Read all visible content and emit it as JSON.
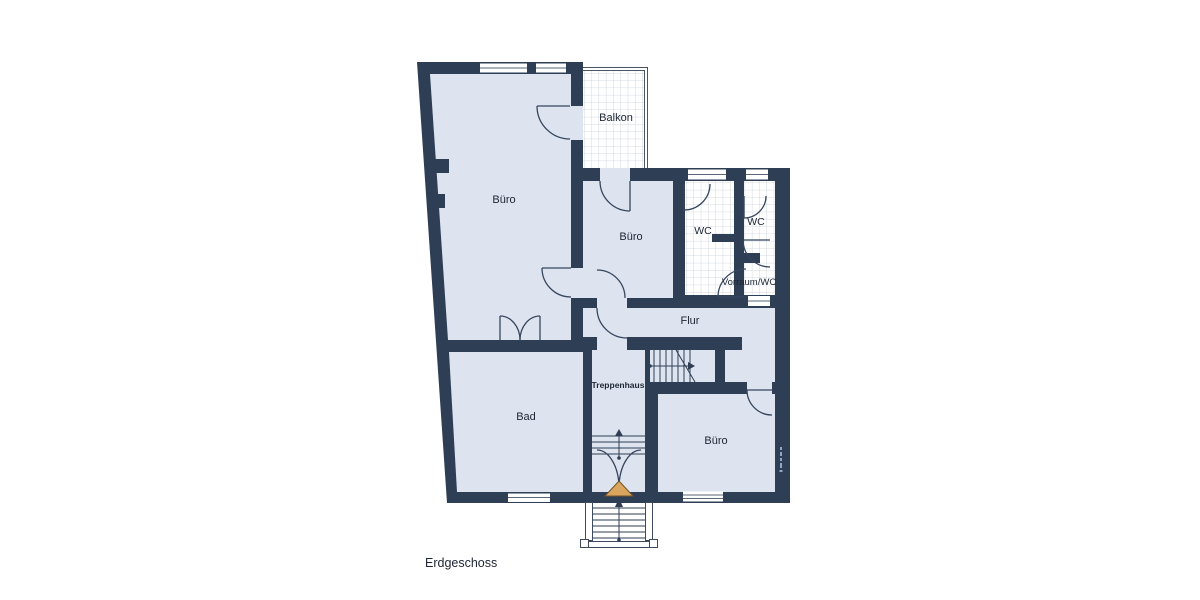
{
  "title": {
    "floor_label": "Erdgeschoss"
  },
  "rooms": {
    "buero_top_left": {
      "label": "Büro"
    },
    "balkon": {
      "label": "Balkon"
    },
    "buero_middle": {
      "label": "Büro"
    },
    "wc_main": {
      "label": "WC"
    },
    "wc_small": {
      "label": "WC"
    },
    "vorraum_wc": {
      "label": "Vorraum/WC"
    },
    "flur": {
      "label": "Flur"
    },
    "treppenhaus": {
      "label": "Treppenhaus"
    },
    "bad": {
      "label": "Bad"
    },
    "buero_bottom_right": {
      "label": "Büro"
    }
  },
  "colors": {
    "wall": "#2e3e55",
    "room_fill": "#dde4ef",
    "tile_line": "#c9cfd8",
    "door": "#35465e",
    "label_text": "#1d2533",
    "entrance_marker": "#daa55e",
    "entrance_marker_border": "#705426",
    "background": "#ffffff",
    "watermark": "#93a7c4"
  }
}
